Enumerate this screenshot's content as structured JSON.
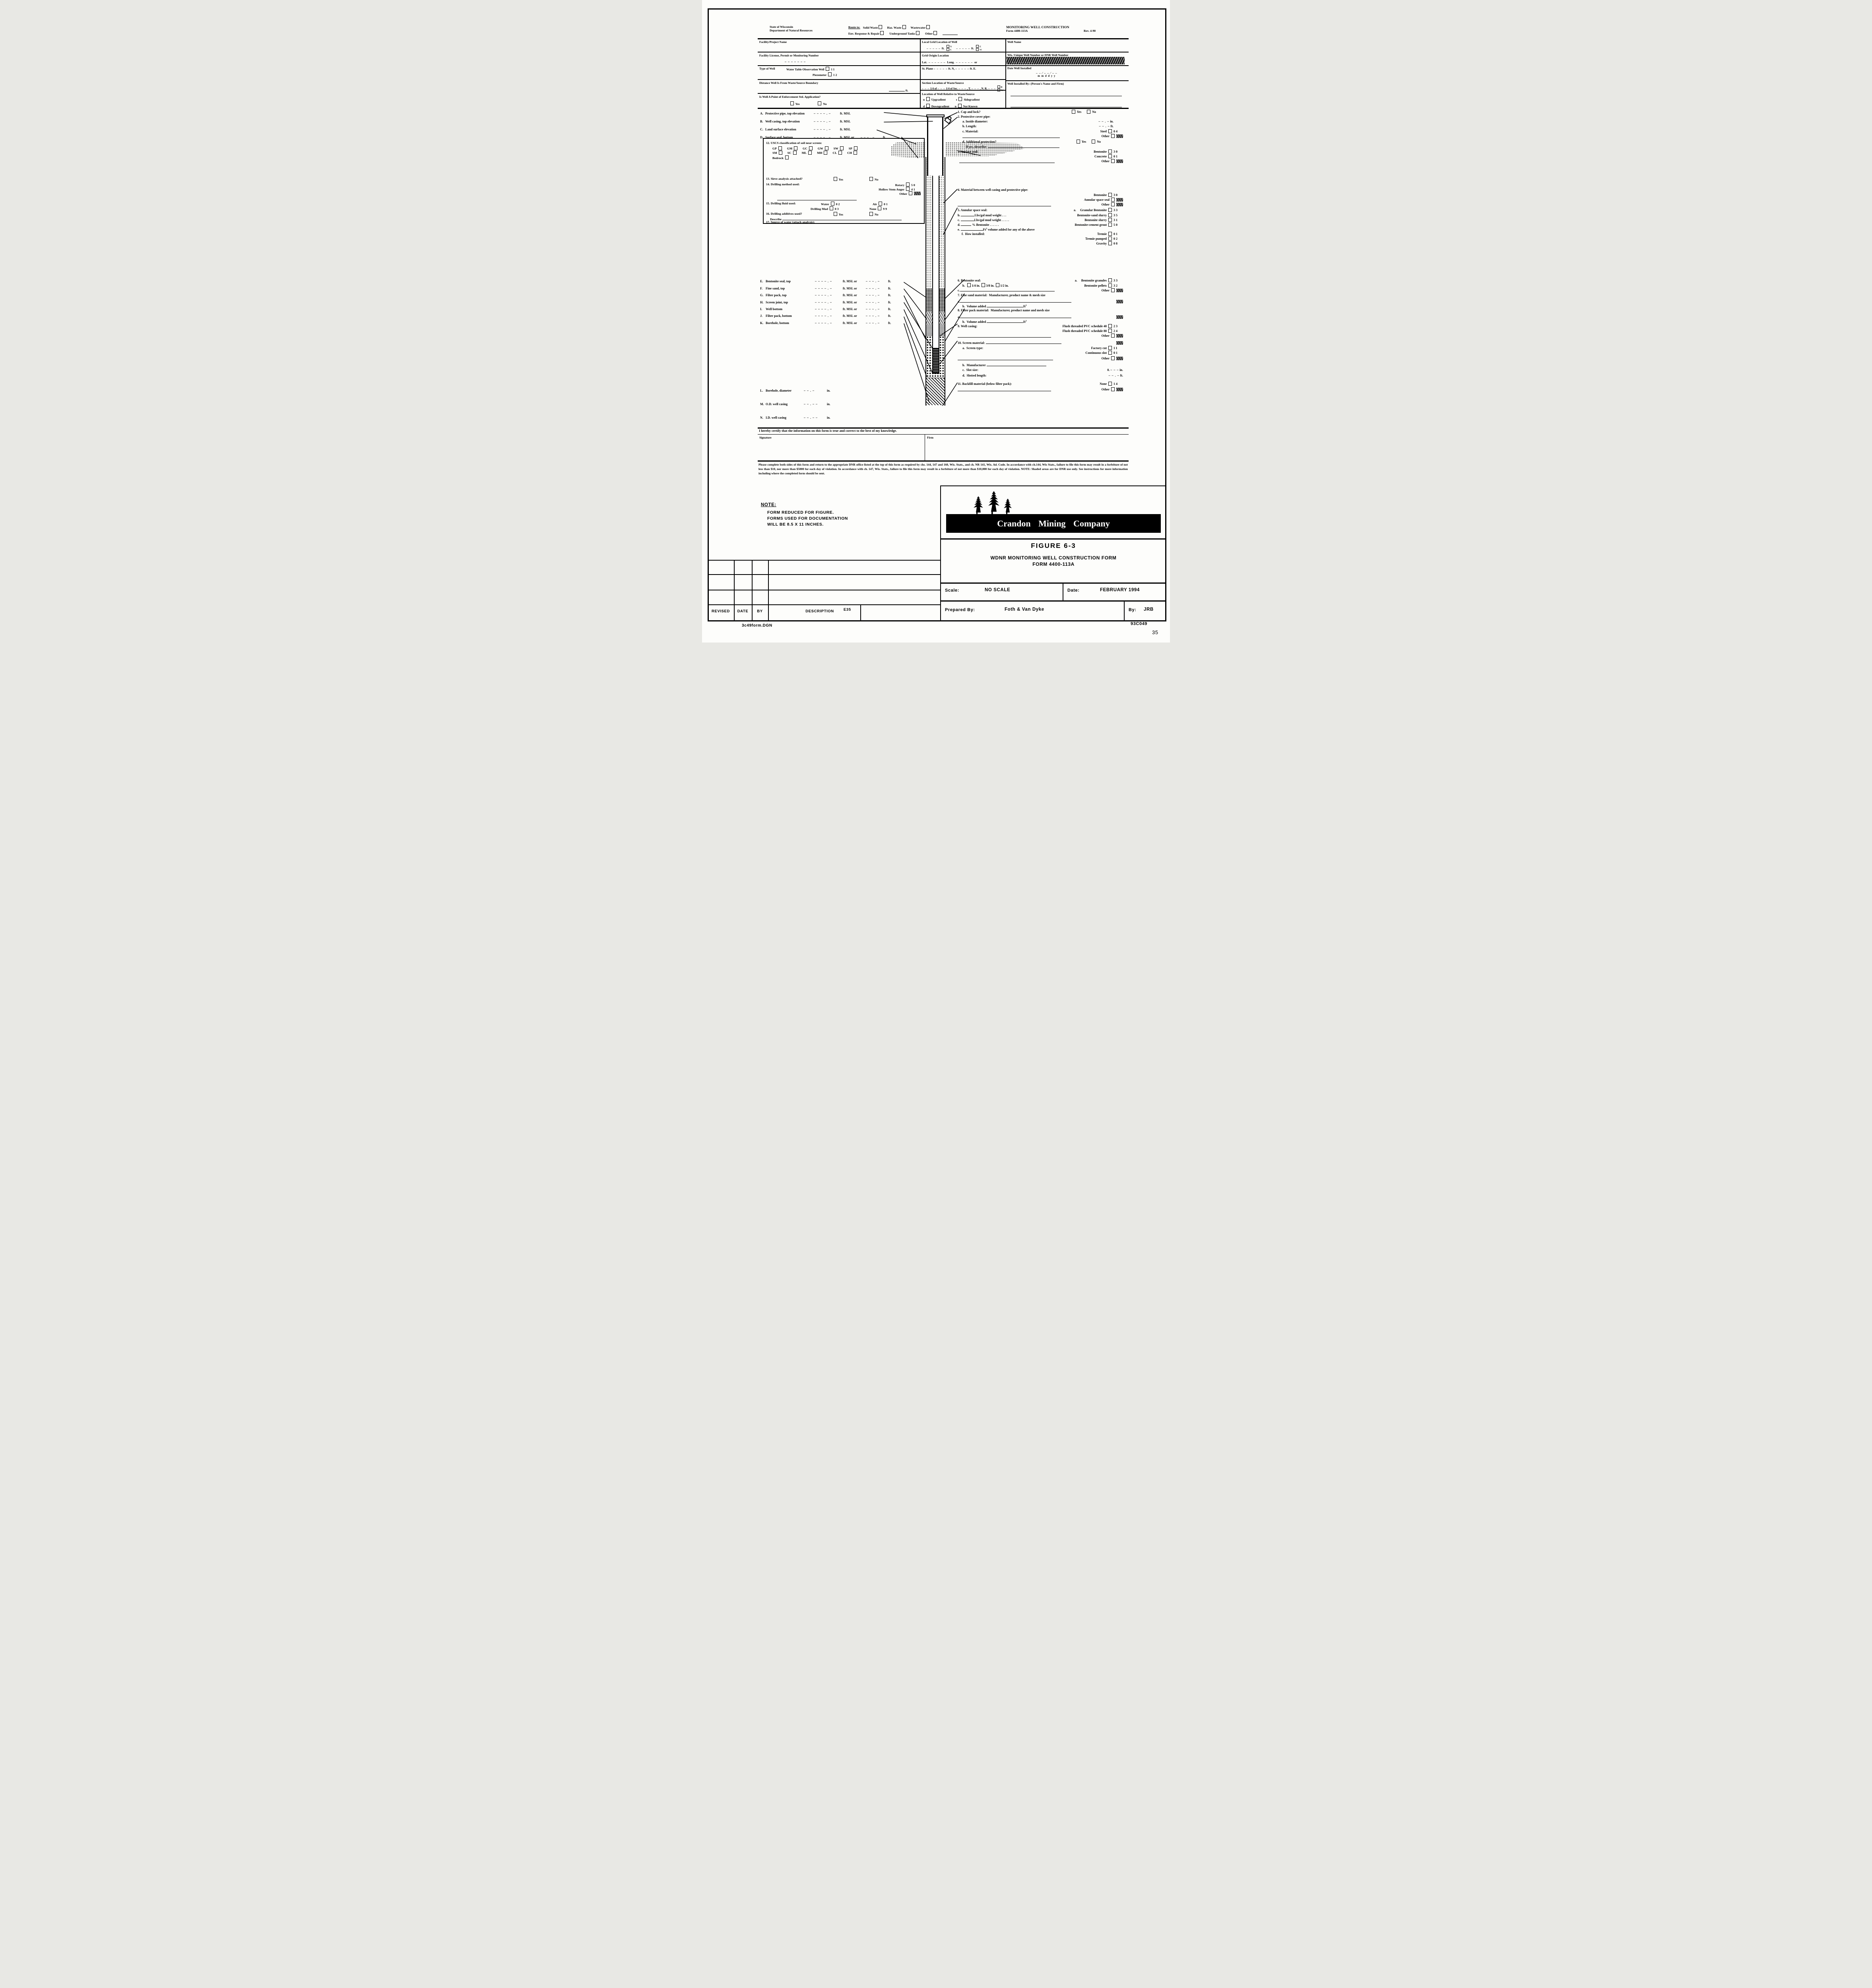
{
  "header": {
    "agency1": "State of Wisconsin",
    "agency2": "Department of Natural Resources",
    "route_label": "Route to:",
    "route1": [
      {
        "label": "Solid Waste"
      },
      {
        "label": "Haz. Waste"
      },
      {
        "label": "Wastewater"
      }
    ],
    "route2": [
      {
        "label": "Env. Response & Repair"
      },
      {
        "label": "Underground Tanks"
      },
      {
        "label": "Other"
      }
    ],
    "title": "MONITORING WELL CONSTRUCTION",
    "form_no": "Form 4400-113A",
    "rev": "Rev. 4-90"
  },
  "grid": {
    "facility_name": "Facility/Project Name",
    "local_grid": "Local Grid Location of Well",
    "well_name": "Well Name",
    "ft": "ft.",
    "n": "N",
    "s": "S",
    "e": "E",
    "w": "W",
    "blank_ft": "– – – – –",
    "facility_license": "Facility License, Permit or Monitoring Number",
    "license_blank": "– – – – – – –",
    "grid_origin": "Grid Origin Location",
    "lat": "Lat.",
    "long": "Long.",
    "or": "or",
    "latlong_blank": "– – – – – –",
    "unique": "Wis. Unique Well Number or DNR Well Number",
    "unique_blank": "– – – –   – – –",
    "type_of_well": "Type of Well",
    "wt": "Water Table Observation Well",
    "wt_code": "11",
    "pz": "Piezometer",
    "pz_code": "12",
    "st_plane": "St. Plane",
    "ft_n": "ft. N,",
    "ft_e": "ft. E.",
    "plane_blank": "– – – – –",
    "date_installed": "Date Well Installed",
    "date_top": "– –  ⁄  – –  ⁄  – –",
    "date_bottom": "m m     d d     y y",
    "section_loc": "Section Location of Waste/Source",
    "sec_blank": "– – –",
    "quarter": "1/4 of",
    "quarter2": "1/4 of Sec.",
    "t": ", T.",
    "nr": ", N. R.",
    "distance": "Distance Well Is From Waste/Source Boundary",
    "installed_by": "Well Installed By:  (Person's Name and Firm)",
    "enforce": "Is Well A Point of Enforcement Std. Application?",
    "yes": "Yes",
    "no": "No",
    "rel_loc": "Location of Well Relative to Waste/Source",
    "u": "u",
    "upgradient": "Upgradient",
    "s_key": "s",
    "sidegradient": "Sidegradient",
    "d_key": "d",
    "downgradient": "Downgradient",
    "n_key": "n",
    "not_known": "Not Known"
  },
  "left": {
    "elev": [
      {
        "key": "A.",
        "label": "Protective pipe, top elevation",
        "blank": "– – – – . –",
        "unit": "ft. MSL",
        "blank2": "",
        "unit2": ""
      },
      {
        "key": "B.",
        "label": "Well casing, top elevation",
        "blank": "– – – – . –",
        "unit": "ft. MSL",
        "blank2": "",
        "unit2": ""
      },
      {
        "key": "C.",
        "label": "Land surface elevation",
        "blank": "– – – – . –",
        "unit": "ft. MSL",
        "blank2": "",
        "unit2": ""
      },
      {
        "key": "D.",
        "label": "Surface seal, bottom",
        "blank": "– – – – . –",
        "unit": "ft. MSL or",
        "blank2": "– – – . –",
        "unit2": "ft."
      }
    ],
    "box": {
      "i12": "12. USCS classification  of soil near screen:",
      "uscs1": [
        {
          "label": "GP"
        },
        {
          "label": "GM"
        },
        {
          "label": "GC"
        },
        {
          "label": "GW"
        },
        {
          "label": "SW"
        },
        {
          "label": "SP"
        }
      ],
      "uscs2": [
        {
          "label": "SM"
        },
        {
          "label": "SC"
        },
        {
          "label": "ML"
        },
        {
          "label": "MH"
        },
        {
          "label": "CL"
        },
        {
          "label": "CH"
        }
      ],
      "bedrock": "Bedrock",
      "i13": "13. Sieve analysis attached?",
      "yes": "Yes",
      "no": "No",
      "i14": "14. Drilling method used:",
      "rotary": "Rotary",
      "rotary_code": "50",
      "hsa": "Hollow Stem Auger",
      "hsa_code": "41",
      "other": "Other",
      "i15": "15. Drilling fluid used:",
      "water": "Water",
      "water_code": "02",
      "air": "Air",
      "air_code": "01",
      "mud": "Drilling Mud",
      "mud_code": "03",
      "none": "None",
      "none_code": "99",
      "i16": "16. Drilling additives used?",
      "describe": "Describe",
      "i17": "17. Source of water (attach analysis):"
    },
    "depth": [
      {
        "key": "E.",
        "label": "Bentonite seal, top"
      },
      {
        "key": "F.",
        "label": "Fine sand, top"
      },
      {
        "key": "G.",
        "label": "Filter pack, top"
      },
      {
        "key": "H.",
        "label": "Screen joint, top"
      },
      {
        "key": "I.",
        "label": "Well bottom"
      },
      {
        "key": "J.",
        "label": "Filter pack, bottom"
      },
      {
        "key": "K.",
        "label": "Borehole, bottom"
      }
    ],
    "depth_blank": "– – – – . –",
    "depth_unit": "ft. MSL or",
    "depth_blank2": "– – – . –",
    "depth_unit2": "ft.",
    "size": [
      {
        "key": "L.",
        "label": "Borehole, diameter",
        "blank": "– – . –",
        "unit": "in."
      },
      {
        "key": "M.",
        "label": "O.D. well casing",
        "blank": "– – . – –",
        "unit": "in."
      },
      {
        "key": "N.",
        "label": "I.D. well casing",
        "blank": "– – . – –",
        "unit": "in."
      }
    ]
  },
  "right": {
    "i1": "1. Cap and lock?",
    "yes": "Yes",
    "no": "No",
    "i2": "2. Protective cover pipe:",
    "i2a": "a. Inside diameter:",
    "i2a_blank": "– – . –",
    "in": "in.",
    "i2b": "b. Length:",
    "i2b_blank": "– – . –",
    "ft": "ft.",
    "i2c": "c. Material:",
    "steel": "Steel",
    "steel_code": "04",
    "other": "Other",
    "i2d": "d. Additional protection?",
    "if_yes": "If yes, describe:",
    "i3": "3. Surface seal:",
    "bentonite": "Bentonite",
    "bent_code": "30",
    "concrete": "Concrete",
    "conc_code": "01",
    "i4": "4. Material between well casing and protective pipe:",
    "annular": "Annular space seal",
    "i5": "5. Annular space seal:",
    "i5a": "a.",
    "i5a_label": "Granular Bentonite",
    "i5a_code": "33",
    "i5b": "b.",
    "i5b_mid": "Lbs/gal mud weight . . .",
    "i5b_label": "Bentonite-sand slurry",
    "i5b_code": "35",
    "i5c": "c.",
    "i5c_mid": "Lbs/gal mud weight . . . . .",
    "i5c_label": "Bentonite slurry",
    "i5c_code": "31",
    "i5d": "d.",
    "i5d_mid": "% Bentonite  . . . . . .",
    "i5d_label": "Bentonite-cement grout",
    "i5d_code": "50",
    "i5e": "e.",
    "i5e_unit": "Ft",
    "i5e_sup": "3",
    "i5e_label": "volume added for any of the above",
    "i5f": "f.",
    "i5f_label": "How installed:",
    "tremie": "Tremie",
    "tremie_code": "01",
    "tremie_p": "Tremie pumped",
    "tremie_p_code": "02",
    "gravity": "Gravity",
    "gravity_code": "08",
    "i6": "6. Bentonite seal:",
    "i6a": "a.",
    "i6a_label": "Bentonite granules",
    "i6a_code": "33",
    "i6b": "b.",
    "i6b_s1": "1/4 in.",
    "i6b_s2": "3/8 in.",
    "i6b_s3": "1/2 in.",
    "i6b_label": "Bentonite pellets",
    "i6b_code": "32",
    "i6c": "c.",
    "i7": "7. Fine sand material:",
    "i7_sub": "Manufacturer, product name & mesh size",
    "i7a": "a.",
    "i7b": "b.",
    "vol": "Volume added",
    "ft_unit": "ft",
    "sup3": "3",
    "i8": "8. Filter pack material:",
    "i8_sub": "Manufacturer, product name and mesh  size",
    "i8a": "a.",
    "i8b": "b.",
    "i9": "9. Well casing:",
    "pvc40": "Flush threaded PVC schedule 40",
    "pvc40_code": "23",
    "pvc80": "Flush threaded PVC schedule 80",
    "pvc80_code": "24",
    "i10": "10. Screen material:",
    "i10a": "a.",
    "i10a_label": "Screen type:",
    "factory": "Factory cut",
    "factory_code": "11",
    "cont": "Continuous slot",
    "cont_code": "01",
    "i10b": "b.",
    "manufacturer": "Manufacturer",
    "i10c": "c.",
    "slot": "Slot size:",
    "slot_prefix": "0.",
    "slot_blank": "– – –",
    "in2": "in.",
    "i10d": "d.",
    "slotted": "Slotted length:",
    "slotted_blank": "– – . –",
    "ft2": "ft.",
    "i11": "11. Backfill material (below filter pack):",
    "none": "None",
    "none_code": "14"
  },
  "cert": {
    "statement": "I hereby certify that the information on this form is true and correct to the best of my knowledge.",
    "signature": "Signature",
    "firm": "Firm"
  },
  "footer_para": "Please complete both sides of this form and return to the appropriate DNR office listed at the top of this form as required by chs. 144, 147 and 160, Wis. Stats., and ch. NR 141, Wis. Ad. Code.  In accordance with ch.144, Wis Stats., failure to file this form may result in a forfeiture of not less than $10, nor more than $5000 for each day of violation.  In accordance with ch. 147, Wis. Stats., failure to file this form may result in a forfeiture of not more than $10,000 for each day of violation.  NOTE:  Shaded areas are for DNR use only.  See instructions for more information including where the completed form should be sent.",
  "note": {
    "heading": "NOTE:",
    "l1": "FORM REDUCED FOR FIGURE.",
    "l2": "FORMS USED FOR DOCUMENTATION",
    "l3": "WILL BE 8.5 X 11 INCHES."
  },
  "tblock": {
    "company": "Crandon Mining Company",
    "figure": "FIGURE 6-3",
    "t1": "WDNR MONITORING WELL CONSTRUCTION FORM",
    "t2": "FORM 4400-113A",
    "scale_l": "Scale:",
    "scale_v": "NO SCALE",
    "date_l": "Date:",
    "date_v": "FEBRUARY 1994",
    "prep_l": "Prepared By:",
    "prep_v": "Foth & Van Dyke",
    "by_l": "By:",
    "by_v": "JRB"
  },
  "rev_table": {
    "headers": [
      {
        "label": "REVISED"
      },
      {
        "label": "DATE"
      },
      {
        "label": "BY"
      },
      {
        "label": "DESCRIPTION"
      }
    ],
    "code": "E35"
  },
  "strip": {
    "file": "3c49form.DGN",
    "doc": "93C049",
    "page": "35"
  }
}
